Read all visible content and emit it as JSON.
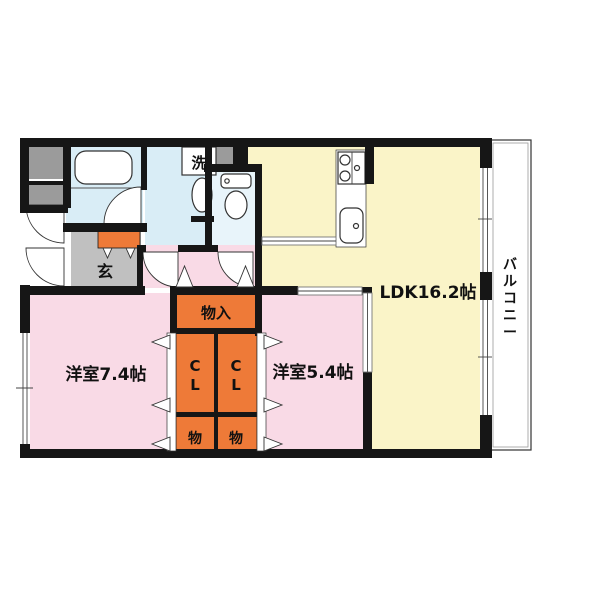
{
  "colors": {
    "wall": "#161616",
    "ldk": "#FAF4C8",
    "bedroom": "#F9DAE6",
    "storage": "#EE7A38",
    "bath": "#D9EDF6",
    "toilet": "#E8F4FA",
    "entrance_gray": "#C0C0C0",
    "meter_gray": "#9B9B9B"
  },
  "plan": {
    "rooms": {
      "ldk": {
        "label": "LDK16.2帖"
      },
      "bedroom_left": {
        "label": "洋室7.4帖"
      },
      "bedroom_right": {
        "label": "洋室5.4帖"
      },
      "entrance": {
        "label": "玄"
      },
      "laundry": {
        "label": "洗"
      },
      "storage_main": {
        "label": "物入"
      },
      "closet_left": {
        "chars": [
          "C",
          "L"
        ]
      },
      "closet_right": {
        "chars": [
          "C",
          "L"
        ]
      },
      "storage_left": {
        "label": "物"
      },
      "storage_right": {
        "label": "物"
      },
      "balcony": {
        "label": "バルコニー",
        "chars": [
          "バ",
          "ル",
          "コ",
          "ニ",
          "ー"
        ]
      }
    }
  }
}
